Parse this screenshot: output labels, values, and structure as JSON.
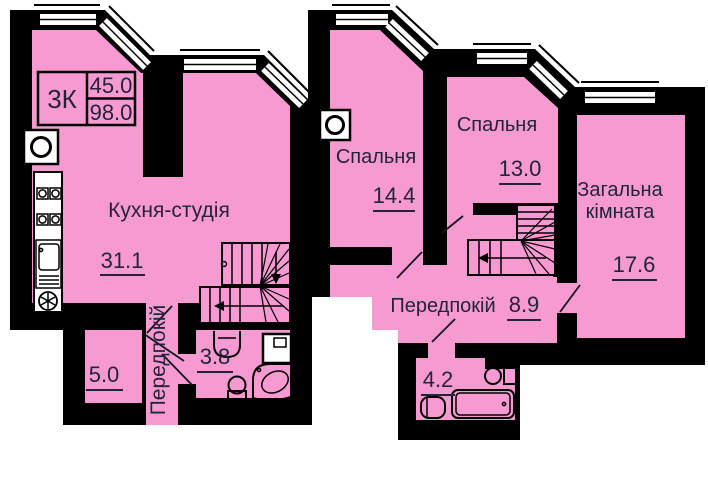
{
  "colors": {
    "room_fill": "#F79AD2",
    "wall": "#000000",
    "window_fill": "#FFFFFF",
    "text": "#23233C"
  },
  "unit_card": {
    "code": "3К",
    "area_top": "45.0",
    "area_bottom": "98.0"
  },
  "floor_lower": {
    "kitchen_studio": {
      "name": "Кухня-студія",
      "area": "31.1"
    },
    "storage_room": {
      "area": "5.0"
    },
    "hallway": {
      "name": "Передпокій"
    },
    "bathroom": {
      "area": "3.8"
    }
  },
  "floor_upper": {
    "bedroom_left": {
      "name": "Спальня",
      "area": "14.4"
    },
    "bedroom_middle": {
      "name": "Спальня",
      "area": "13.0"
    },
    "living_room": {
      "name_line1": "Загальна",
      "name_line2": "кімната",
      "area": "17.6"
    },
    "hallway": {
      "name": "Передпокій",
      "area": "8.9"
    },
    "bathroom": {
      "area": "4.2"
    }
  }
}
